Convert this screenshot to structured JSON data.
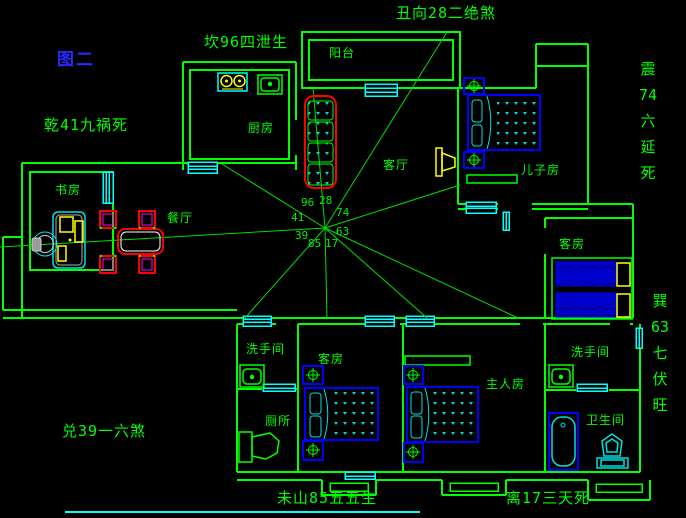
{
  "figure_label": "图二",
  "annotations": {
    "top": "丑向28二绝煞",
    "top_left": "坎96四泄生",
    "left": "乾41九祸死",
    "right_upper": "震74六延死",
    "right_lower": "巽63七伏旺",
    "bottom_left": "兑39一六煞",
    "bottom_center": "未山85五五生",
    "bottom_right": "离17三天死"
  },
  "compass": {
    "center_numbers": {
      "nw": "96",
      "n": "28",
      "ne": "74",
      "w": "41",
      "e": "63",
      "sw": "39",
      "s": "85",
      "se": "17"
    }
  },
  "rooms": {
    "balcony": "阳台",
    "kitchen": "厨房",
    "living": "客厅",
    "son_room": "儿子房",
    "study": "书房",
    "dining": "餐厅",
    "guest_right": "客房",
    "guest_bottom": "客房",
    "master": "主人房",
    "washroom_left": "洗手间",
    "washroom_right": "洗手间",
    "toilet": "厕所",
    "bathroom": "卫生间"
  },
  "colors": {
    "wall_green": "#00ff00",
    "window_cyan": "#00ffff",
    "furniture_blue": "#0000ff",
    "sofa_red": "#ff0000",
    "accent_yellow": "#ffff00",
    "chair_magenta": "#ff00ff",
    "figure_blue": "#2828ff",
    "background": "#000000"
  }
}
